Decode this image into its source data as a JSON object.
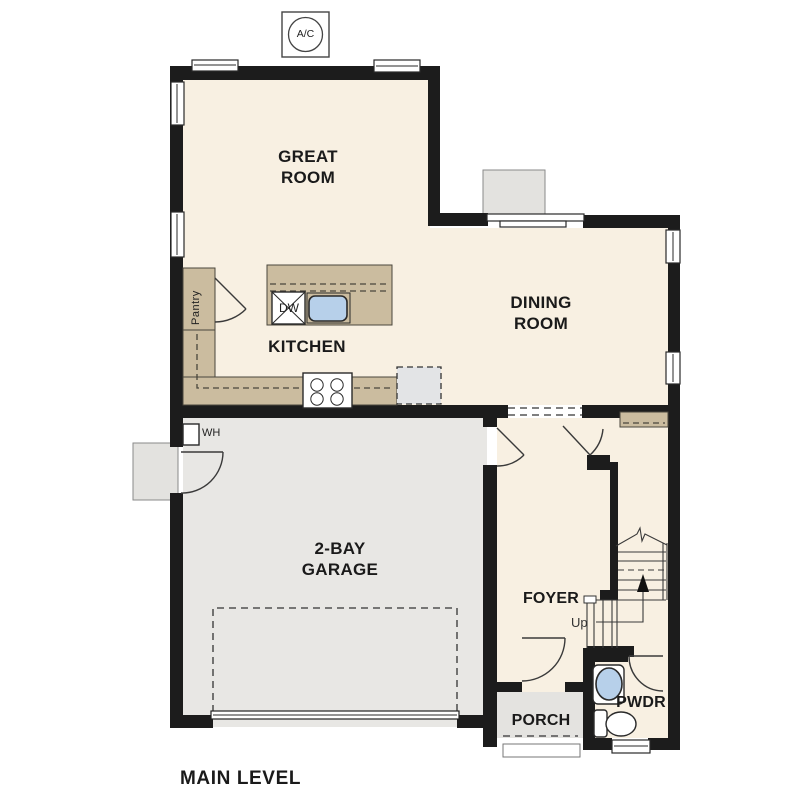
{
  "plan": {
    "title": "MAIN LEVEL",
    "rooms": {
      "great_room": "GREAT ROOM",
      "dining_room": "DINING ROOM",
      "kitchen": "KITCHEN",
      "garage": "2-BAY GARAGE",
      "foyer": "FOYER",
      "porch": "PORCH",
      "powder_room": "PWDR",
      "pantry": "Pantry"
    },
    "annotations": {
      "air_conditioner": "A/C",
      "dishwasher": "DW",
      "water_heater": "WH",
      "stairs_direction": "Up"
    }
  },
  "colors": {
    "wall": "#1c1c1c",
    "floor": "#f8f0e2",
    "garage-floor": "#e8e7e4",
    "porch-floor": "#e4e3e0",
    "counter": "#cbbc9f",
    "sink": "#b7d0ea",
    "text": "#1a1a1a"
  }
}
